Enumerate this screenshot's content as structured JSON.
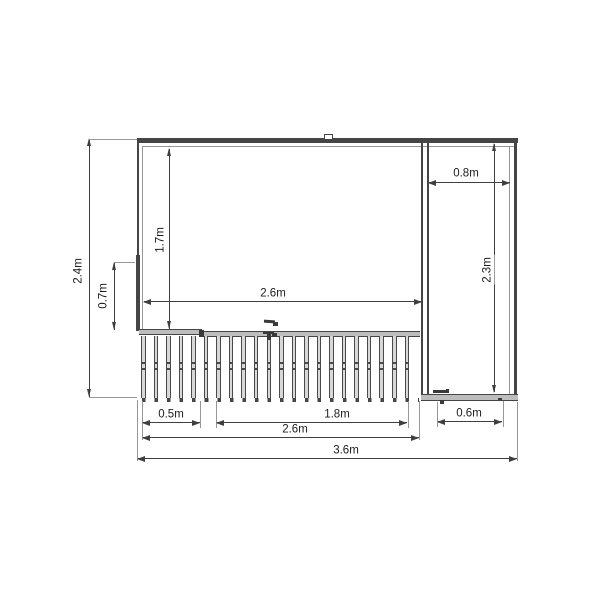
{
  "drawing": {
    "background": "#ffffff",
    "line_color": "#3f3f3f",
    "extension_line_color": "#979797",
    "panel_fill": "#bdbdbd",
    "slat_fill": "#d8d8d8"
  },
  "dimensions": {
    "overall_height": "2.4m",
    "left_panel_height": "0.7m",
    "opening_height": "1.7m",
    "opening_width": "2.6m",
    "side_bay_width": "0.8m",
    "side_bay_height": "2.3m",
    "deck_left_width": "0.5m",
    "deck_gate_width": "1.8m",
    "deck_total_width": "2.6m",
    "side_door_width": "0.6m",
    "overall_width": "3.6m"
  }
}
